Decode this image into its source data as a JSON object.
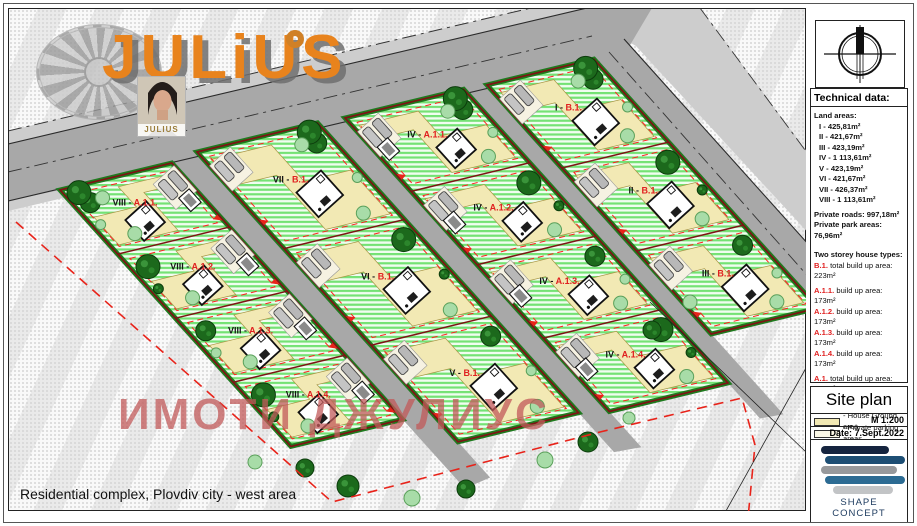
{
  "page": {
    "footer_title": "Residential complex, Plovdiv city - west area",
    "watermark": "ИМОТИ ДЖУЛИУС"
  },
  "logo": {
    "text": "JULiUS",
    "photo_label": "JULIUS"
  },
  "panel": {
    "technical_data_title": "Technical data:",
    "land_areas": {
      "heading": "Land areas:",
      "items": [
        "I - 425,81m²",
        "II - 421,67m²",
        "III - 423,19m²",
        "IV - 1 113,61m²",
        "V - 423,19m²",
        "VI - 421,67m²",
        "VII - 426,37m²",
        "VIII - 1 113,61m²"
      ]
    },
    "private_roads": "Private roads: 997,18m²",
    "private_park": "Private park areas: 76,96m²",
    "house_types": {
      "heading": "Two storey house types:",
      "b1": {
        "code": "B.1.",
        "text": "total build up area: 223m²"
      },
      "a_items": [
        {
          "code": "A.1.1.",
          "text": "build up area: 173m²"
        },
        {
          "code": "A.1.2.",
          "text": "build up area: 173m²"
        },
        {
          "code": "A.1.3.",
          "text": "build up area: 173m²"
        },
        {
          "code": "A.1.4.",
          "text": "build up area: 173m²"
        }
      ],
      "a_total": {
        "code": "A.1.",
        "text": "total build up area: 692m²"
      }
    },
    "legend": [
      {
        "key": "roads",
        "label": "- Roads"
      },
      {
        "key": "house_ground",
        "label": "- House Ground area"
      },
      {
        "key": "private_parking",
        "label": "- Private parking areas"
      },
      {
        "key": "greenery",
        "label": "- Greenery"
      },
      {
        "key": "plot_boundary",
        "label": "- Plot boundary line"
      },
      {
        "key": "setback",
        "label": "- Setback line"
      },
      {
        "key": "entrance",
        "label": "- Entrance"
      }
    ],
    "title_block": {
      "title": "Site plan",
      "scale": "M 1:200",
      "date": "Date: 7.Sept.2022",
      "company": "SHAPE CONCEPT"
    }
  },
  "plan": {
    "strips": [
      {
        "id": "strip-1",
        "plots": [
          "VIII - A.1.1.",
          "VIII - A.1.2.",
          "VIII - A.1.3.",
          "VIII - A.1.4."
        ]
      },
      {
        "id": "strip-2",
        "plots": [
          "VII - B.1.",
          "VI - B.1.",
          "V - B.1."
        ]
      },
      {
        "id": "strip-3",
        "plots": [
          "IV - A.1.1.",
          "IV - A.1.2.",
          "IV - A.1.3.",
          "IV - A.1.4."
        ]
      },
      {
        "id": "strip-4",
        "plots": [
          "I - B.1.",
          "II - B.1.",
          "III - B.1."
        ]
      }
    ],
    "colors": {
      "accent_orange": "#e8831d",
      "plot_boundary": "#7d1414",
      "setback_red": "#e8231a",
      "greenery_stripe": "#74e274",
      "house_ground": "#f2e9b4",
      "road": "#a8a8a8"
    }
  }
}
